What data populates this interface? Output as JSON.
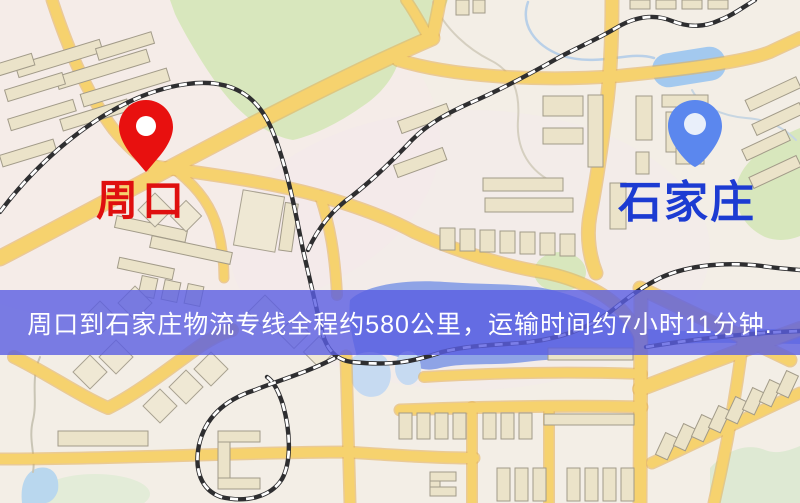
{
  "map": {
    "markers": [
      {
        "name": "周口",
        "pin_color": "#e8100f",
        "pin_hole_color": "#ffffff",
        "label_color": "#df0f0f"
      },
      {
        "name": "石家庄",
        "pin_color": "#5b87ee",
        "pin_hole_color": "#e9effa",
        "label_color": "#1c3bd2"
      }
    ],
    "banner": {
      "text": "周口到石家庄物流专线全程约580公里，运输时间约7小时11分钟.",
      "bg_color": "rgba(90,94,226,0.8)",
      "text_color": "#ffffff"
    },
    "route": {
      "origin": "周口",
      "destination": "石家庄",
      "distance_text": "约580公里",
      "duration_text": "约7小时11分钟"
    }
  }
}
